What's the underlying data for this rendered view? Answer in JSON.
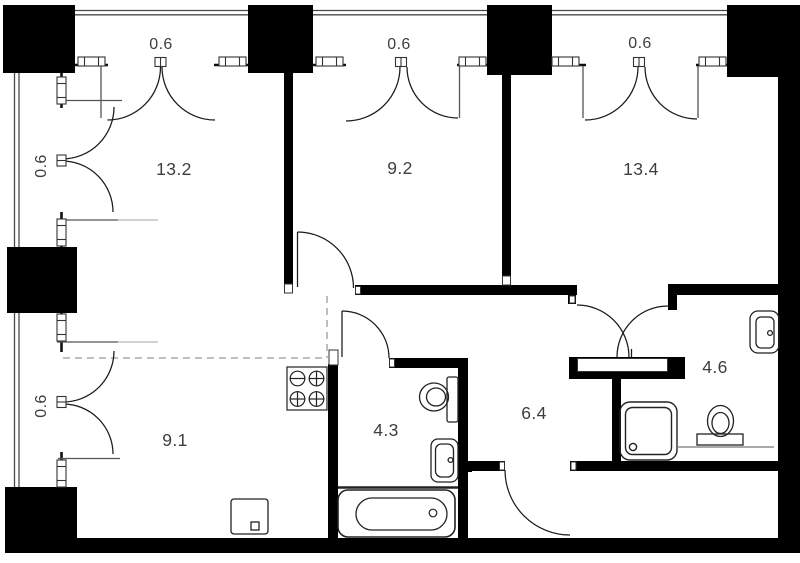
{
  "plan": {
    "colors": {
      "background": "#ffffff",
      "wall": "#000000",
      "line": "#222222",
      "muted_line": "#999999",
      "label": "#3e3e3e"
    },
    "rooms": [
      {
        "id": "room-13-2",
        "area": "13.2"
      },
      {
        "id": "room-9-2",
        "area": "9.2"
      },
      {
        "id": "room-13-4",
        "area": "13.4"
      },
      {
        "id": "room-9-1",
        "area": "9.1"
      },
      {
        "id": "room-4-3",
        "area": "4.3"
      },
      {
        "id": "room-6-4",
        "area": "6.4"
      },
      {
        "id": "room-4-6",
        "area": "4.6"
      }
    ],
    "balconies": [
      {
        "id": "balcony-top-left",
        "area": "0.6"
      },
      {
        "id": "balcony-top-middle",
        "area": "0.6"
      },
      {
        "id": "balcony-top-right",
        "area": "0.6"
      },
      {
        "id": "balcony-left-upper",
        "area": "0.6"
      },
      {
        "id": "balcony-left-lower",
        "area": "0.6"
      }
    ],
    "fixtures": [
      "stove",
      "washing-machine",
      "bathtub",
      "toilet",
      "sink",
      "shower-tray",
      "radiator",
      "wardrobe",
      "door-swing"
    ]
  }
}
